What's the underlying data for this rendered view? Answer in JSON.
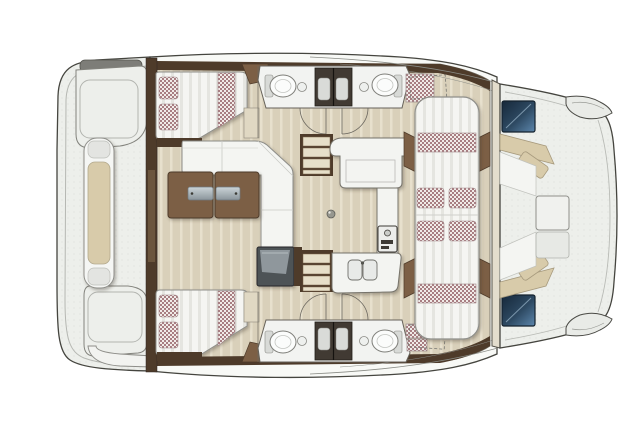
{
  "figure": {
    "type": "floor-plan",
    "subject": "catamaran yacht interior layout, top-down view, bow to the right",
    "view": "top-down",
    "text_on_image": "none"
  },
  "palette": {
    "page_bg": "#ffffff",
    "deck": "#edefeb",
    "deck_rim": "#f8f9f6",
    "outline": "#45453f",
    "floor": "#d9d0ba",
    "floor_stripe": "#e7e0cd",
    "wood_dark": "#4e3b2a",
    "wood_mid": "#7c5f45",
    "counter": "#f3f4f1",
    "furn_stroke": "#83837d",
    "mattress": "#f5f5f2",
    "mattress_stripe": "#e5e5e0",
    "check_bg": "#f1ebe8",
    "check_fg": "#a87e82",
    "cushion": "#d8cbaa",
    "module_dark": "#4e5357",
    "module_top": "#8f979c",
    "shower": "#413a33",
    "shower_tray": "#d9dbd8",
    "hatch_dark": "#1c3044",
    "hatch_light": "#5d87ad",
    "metal_light": "#ccd4d8",
    "metal_dark": "#8a959b",
    "wall_beige": "#e3ddcd"
  },
  "areas": {
    "aft_deck": {
      "label": "aft-deck",
      "items": [
        "transom-bench",
        "corner-seat-top",
        "corner-seat-bottom",
        "boarding-step"
      ]
    },
    "hull_top": {
      "label": "hull-top",
      "items": [
        "double-berth",
        "pillows",
        "wardrobe",
        "bathroom",
        "shower",
        "toilet",
        "washbasin",
        "deck-hatch"
      ]
    },
    "hull_bottom": {
      "label": "hull-bottom",
      "items": [
        "double-berth",
        "pillows",
        "wardrobe",
        "bathroom",
        "shower",
        "toilet",
        "washbasin",
        "deck-hatch"
      ]
    },
    "saloon": {
      "label": "saloon",
      "items": [
        "l-sofa",
        "folding-table",
        "storage-module",
        "companionway-steps-top",
        "companionway-steps-bottom"
      ]
    },
    "galley": {
      "label": "galley",
      "items": [
        "worktop",
        "appliance",
        "stove",
        "double-sink"
      ]
    },
    "center_lounge": {
      "label": "center-lounge",
      "items": [
        "double-lounge-bed",
        "checkered-pillows",
        "checkered-bands",
        "wood-trims"
      ]
    },
    "foredeck_cockpit": {
      "label": "foredeck-cockpit",
      "items": [
        "u-seating",
        "tan-backrests",
        "center-table",
        "deck-hatch-top",
        "deck-hatch-bottom",
        "bow-tip-top",
        "bow-tip-bottom"
      ]
    }
  }
}
